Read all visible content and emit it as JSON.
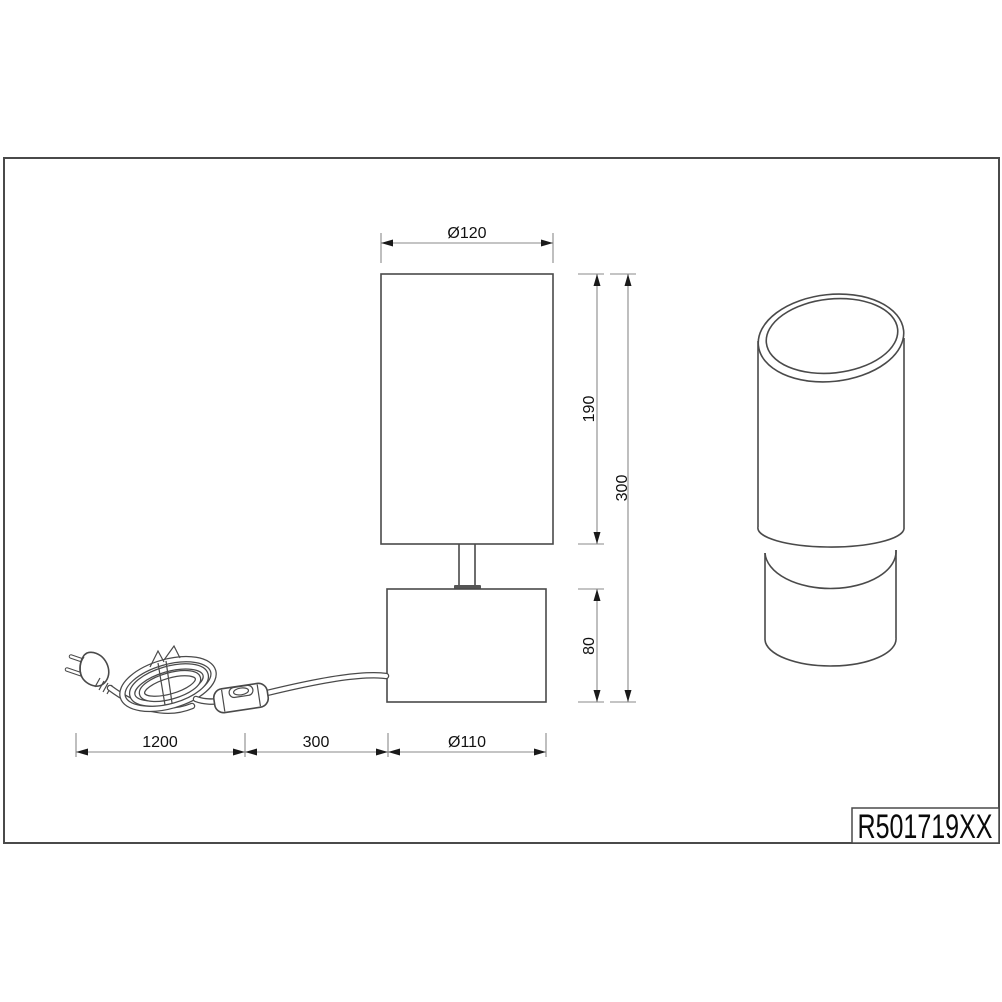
{
  "product_code": "R501719XX",
  "dimensions": {
    "shade_diameter_label": "Ø120",
    "shade_height_label": "190",
    "total_height_label": "300",
    "base_height_label": "80",
    "base_diameter_label": "Ø110",
    "cord_length_label": "1200",
    "cord_switch_distance_label": "300"
  },
  "colors": {
    "object_line": "#4a4a4a",
    "dimension_line": "#8a8a8a",
    "text": "#111111",
    "background": "#ffffff"
  }
}
